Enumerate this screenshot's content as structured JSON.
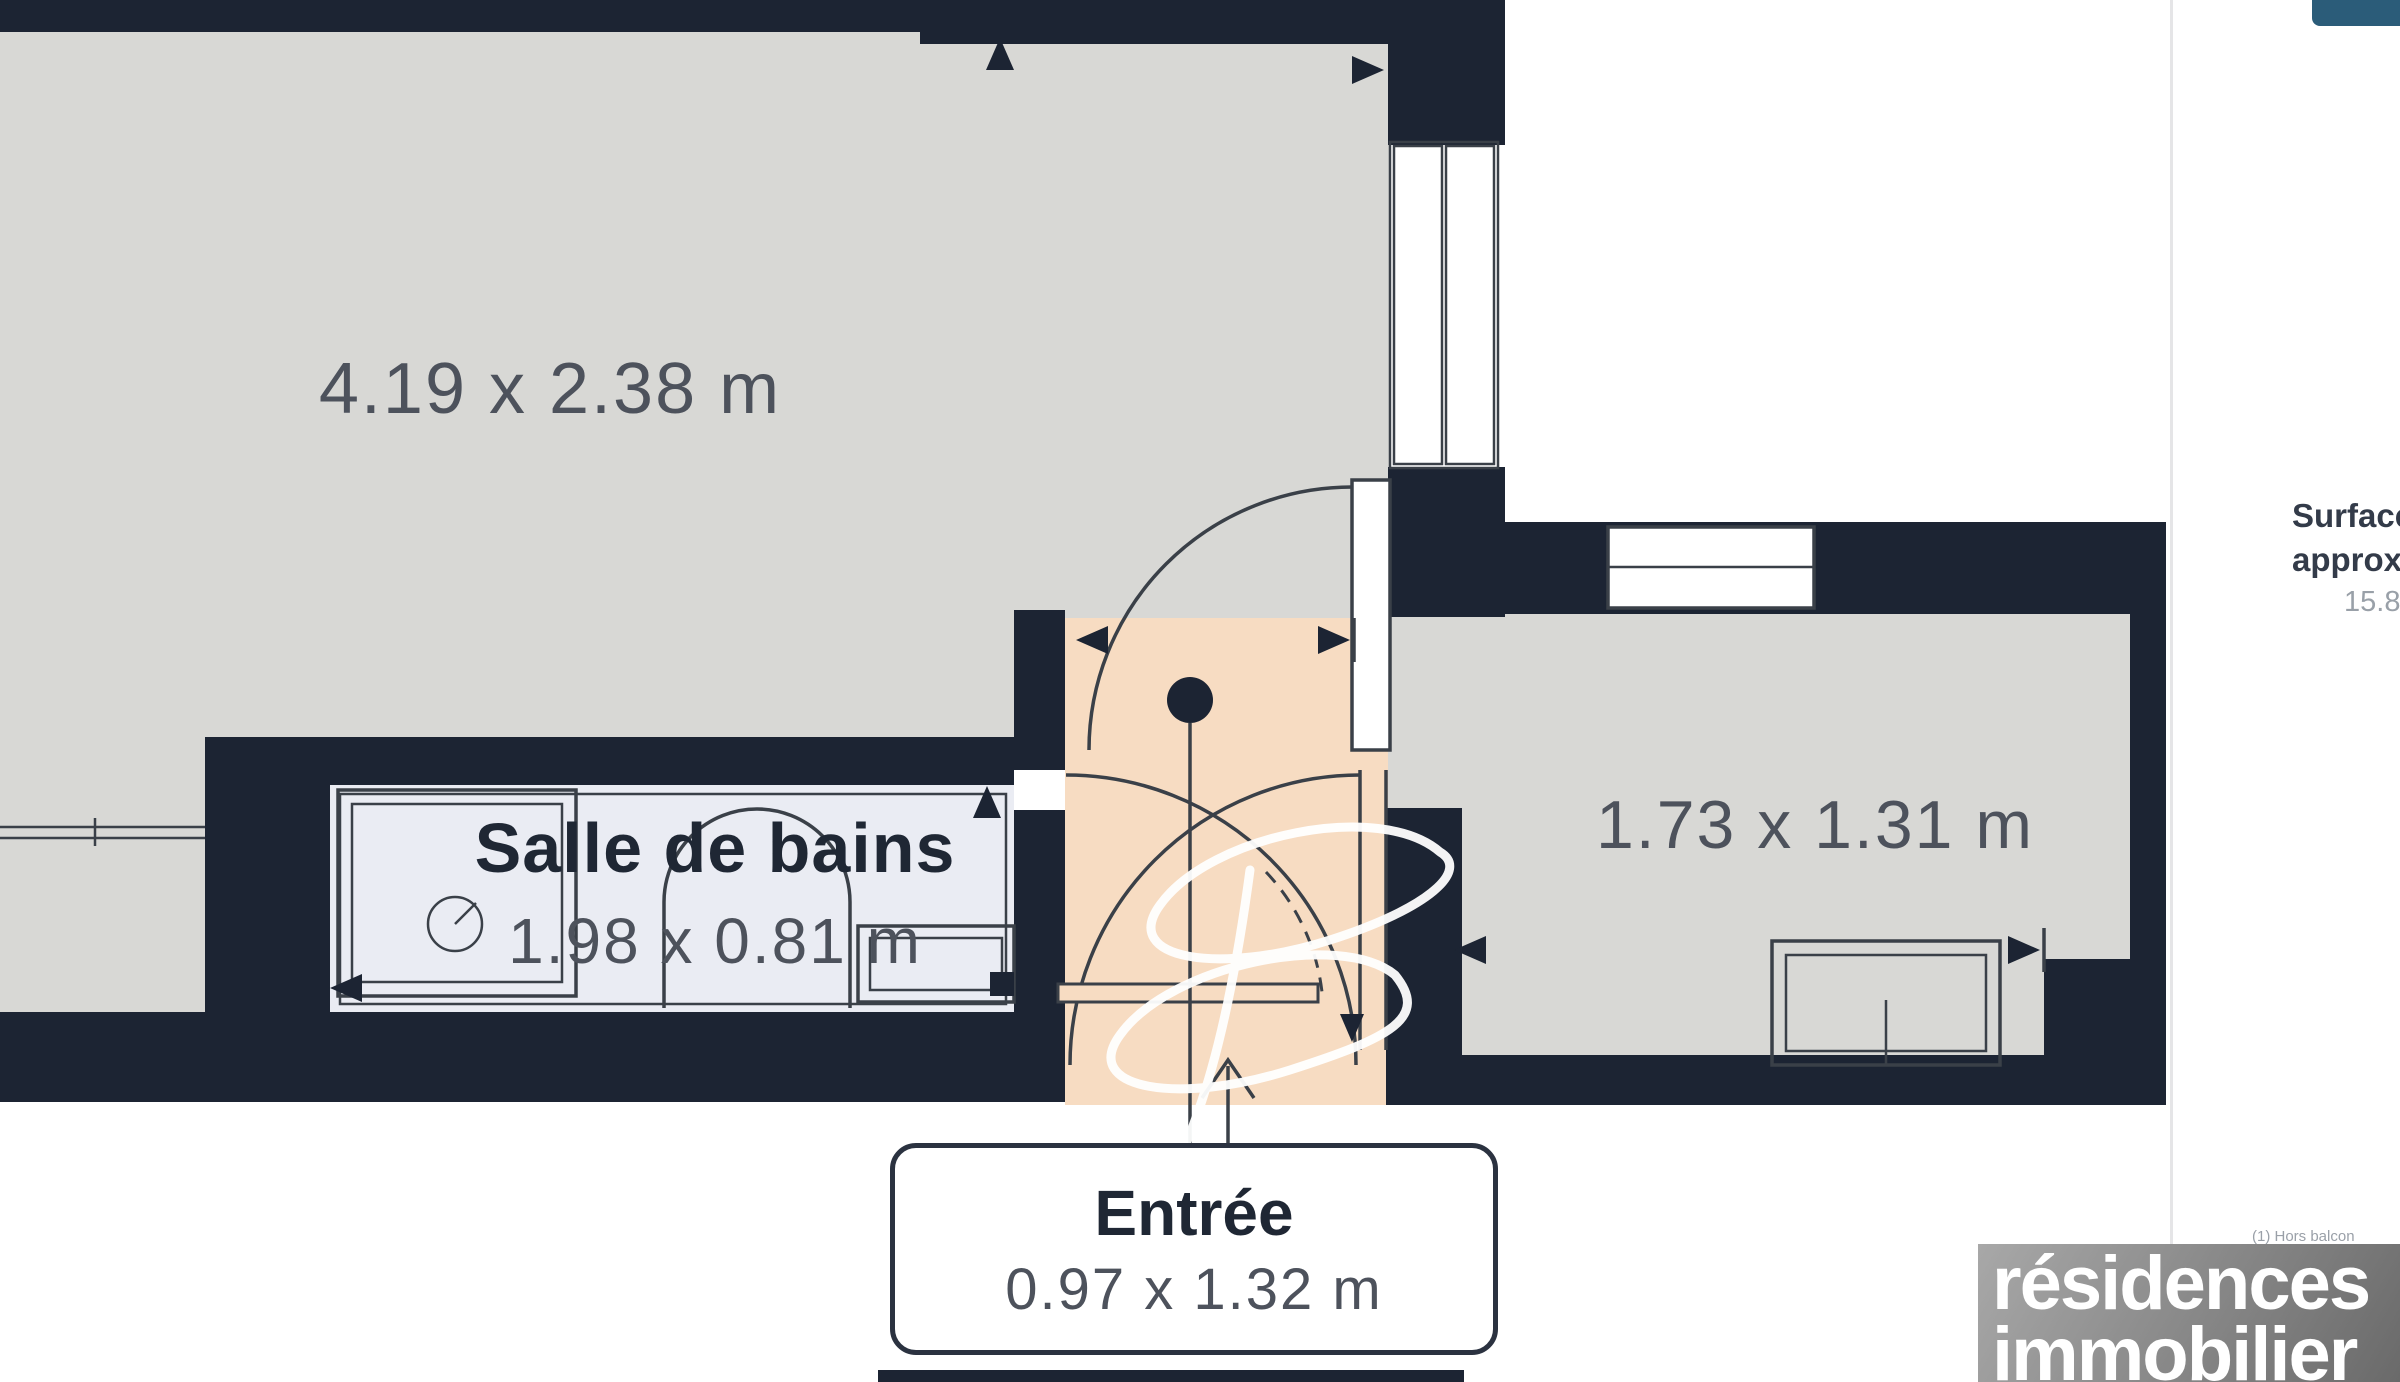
{
  "plan": {
    "colors": {
      "wall": "#1c2433",
      "room_gray": "#d8d8d5",
      "bathroom": "#eaecf3",
      "entrance": "#f7dcc2",
      "line": "#3a4048",
      "dim_text": "#4d525c",
      "label_text": "#1f2734"
    },
    "rooms": {
      "main": {
        "dims": "4.19 x 2.38 m"
      },
      "bathroom": {
        "name": "Salle de bains",
        "dims": "1.98 x 0.81 m"
      },
      "right": {
        "dims": "1.73 x 1.31 m"
      },
      "entrance": {
        "name": "Entrée",
        "dims": "0.97 x 1.32 m"
      }
    }
  },
  "side_panel": {
    "surface_line1": "Surface totale",
    "surface_line2": "approximative",
    "surface_value": "15.83 m²",
    "footnote": "(1) Hors balcon"
  },
  "branding": {
    "line1": "résidences",
    "line2": "immobilier",
    "accent": "#2b5c79"
  }
}
